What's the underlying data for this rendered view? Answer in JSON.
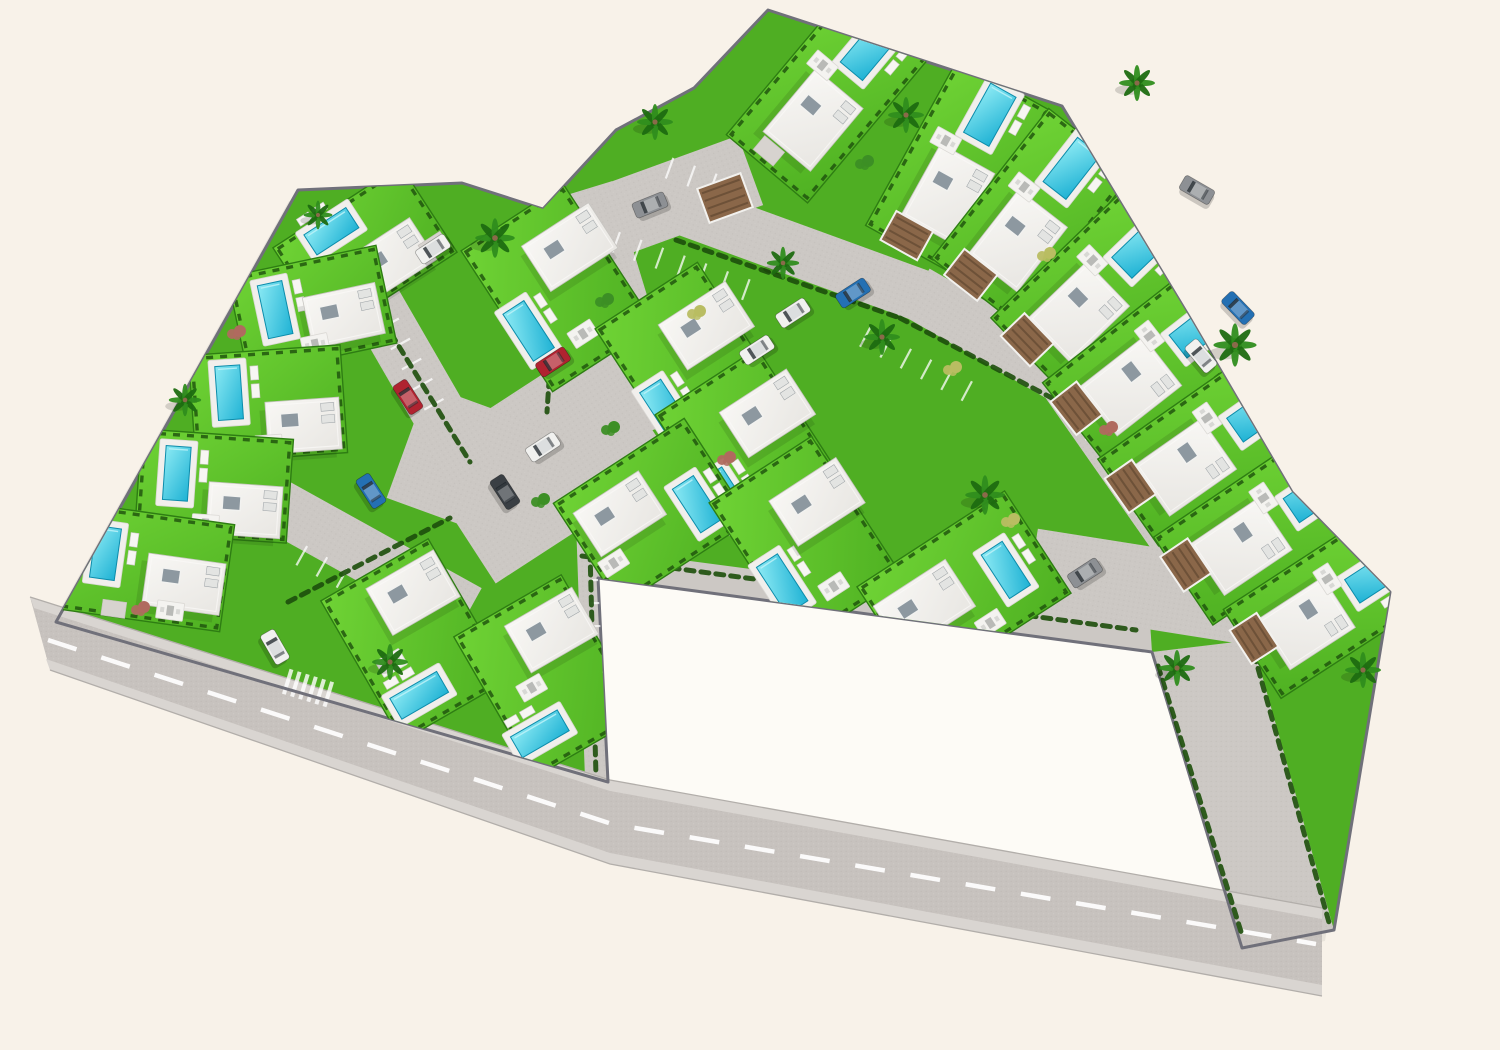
{
  "meta": {
    "canvas": {
      "w": 1500,
      "h": 1050
    }
  },
  "palette": {
    "bg": "#f8f2e9",
    "parcel": "#fdfbf6",
    "grassBase": "#4fae23",
    "lawnLight": "#6fd335",
    "lawnDark": "#4fb122",
    "lawnEdge": "#2e7d13",
    "hedge": "#1d4f0c",
    "road": "#c7c2be",
    "paved": "#ccc8c4",
    "sidewalk": "#d9d5d1",
    "roadEdge": "#b2aeaa",
    "wall": "#70707a",
    "dash": "#ffffff",
    "deck": "#f1efec",
    "waterLight": "#8ceaf4",
    "waterDark": "#1fb2d4",
    "waterEdge": "#0c8cab",
    "roofLight": "#f8f7f4",
    "roofDark": "#e8e6e2",
    "roofStroke": "#c7c5c1",
    "skylight": "#8d98a0",
    "pergola": "#8a6749",
    "pergolaSlat": "#6d5138",
    "drive": "#d7d3cf",
    "carColors": {
      "red": "#b02330",
      "blue": "#2470b3",
      "white": "#f1f1ef",
      "gray": "#8d9094",
      "dark": "#3a3f44"
    }
  },
  "site": {
    "outline": [
      [
        56,
        622
      ],
      [
        298,
        190
      ],
      [
        462,
        183
      ],
      [
        543,
        209
      ],
      [
        616,
        130
      ],
      [
        694,
        88
      ],
      [
        768,
        10
      ],
      [
        1062,
        106
      ],
      [
        1190,
        318
      ],
      [
        1292,
        492
      ],
      [
        1390,
        592
      ],
      [
        1334,
        930
      ],
      [
        1242,
        948
      ],
      [
        1152,
        652
      ],
      [
        598,
        578
      ],
      [
        608,
        782
      ]
    ],
    "parcel": [
      [
        598,
        578
      ],
      [
        1152,
        652
      ],
      [
        1238,
        940
      ],
      [
        608,
        782
      ]
    ]
  },
  "roads": {
    "bottom": [
      [
        30,
        597
      ],
      [
        610,
        780
      ],
      [
        1322,
        908
      ],
      [
        1322,
        996
      ],
      [
        610,
        864
      ],
      [
        50,
        670
      ]
    ],
    "sidewalkTop": [
      [
        30,
        597
      ],
      [
        610,
        780
      ],
      [
        1322,
        908
      ],
      [
        1322,
        919
      ],
      [
        610,
        791
      ],
      [
        34,
        608
      ]
    ],
    "sidewalkBottom": [
      [
        1322,
        985
      ],
      [
        610,
        853
      ],
      [
        46,
        659
      ],
      [
        50,
        670
      ],
      [
        610,
        864
      ],
      [
        1322,
        996
      ]
    ],
    "edgeTop": [
      [
        30,
        597
      ],
      [
        610,
        780
      ],
      [
        1322,
        908
      ]
    ],
    "edgeBottom": [
      [
        50,
        670
      ],
      [
        610,
        864
      ],
      [
        1322,
        996
      ]
    ],
    "dash": [
      [
        48,
        640
      ],
      [
        612,
        824
      ],
      [
        1316,
        944
      ]
    ],
    "strip": [
      [
        1152,
        652
      ],
      [
        1252,
        640
      ],
      [
        1334,
        930
      ],
      [
        1242,
        948
      ]
    ],
    "walk": [
      [
        592,
        548
      ],
      [
        1150,
        622
      ],
      [
        1152,
        652
      ],
      [
        598,
        578
      ]
    ],
    "pavedRects": [
      {
        "x": 618,
        "y": 310,
        "r": -17,
        "w": 64,
        "h": 250
      },
      {
        "x": 680,
        "y": 196,
        "r": -20,
        "w": 150,
        "h": 74
      },
      {
        "x": 790,
        "y": 248,
        "r": 20,
        "w": 300,
        "h": 52
      },
      {
        "x": 1020,
        "y": 352,
        "r": 30,
        "w": 240,
        "h": 54
      },
      {
        "x": 1130,
        "y": 468,
        "r": 55,
        "w": 220,
        "h": 58
      },
      {
        "x": 545,
        "y": 462,
        "r": -33,
        "w": 215,
        "h": 150
      },
      {
        "x": 480,
        "y": 468,
        "r": 20,
        "w": 155,
        "h": 120
      },
      {
        "x": 415,
        "y": 372,
        "r": 60,
        "w": 235,
        "h": 54
      },
      {
        "x": 368,
        "y": 556,
        "r": 29,
        "w": 230,
        "h": 54
      },
      {
        "x": 612,
        "y": 664,
        "r": 88,
        "w": 255,
        "h": 62
      },
      {
        "x": 1150,
        "y": 588,
        "r": 9,
        "w": 240,
        "h": 82
      }
    ],
    "parkingRows": [
      {
        "x": 681,
        "y": 266,
        "r": 20,
        "n": 6
      },
      {
        "x": 916,
        "y": 364,
        "r": 28,
        "n": 5
      },
      {
        "x": 406,
        "y": 354,
        "r": 61,
        "n": 5
      },
      {
        "x": 342,
        "y": 578,
        "r": 29,
        "n": 4
      },
      {
        "x": 602,
        "y": 626,
        "r": 89,
        "n": 4
      },
      {
        "x": 1120,
        "y": 472,
        "r": 56,
        "n": 4
      },
      {
        "x": 702,
        "y": 180,
        "r": 20,
        "n": 3
      }
    ],
    "zebra": {
      "x": 308,
      "y": 688,
      "r": 17,
      "n": 6
    }
  },
  "hedgeLines": [
    [
      676,
      240,
      900,
      318
    ],
    [
      900,
      318,
      1086,
      416
    ],
    [
      582,
      556,
      1136,
      630
    ],
    [
      1158,
      666,
      1243,
      938
    ],
    [
      1254,
      654,
      1330,
      926
    ],
    [
      352,
      270,
      470,
      462
    ],
    [
      288,
      602,
      450,
      518
    ],
    [
      590,
      552,
      596,
      776
    ],
    [
      650,
      552,
      654,
      700
    ],
    [
      560,
      214,
      547,
      412
    ]
  ],
  "villas": [
    {
      "x": 365,
      "y": 250,
      "r": -33,
      "lawn": [
        152,
        104
      ],
      "pool": [
        -18,
        -34,
        50,
        24
      ],
      "house": [
        18,
        22,
        74,
        50
      ],
      "terr": [
        -44,
        6
      ],
      "drive": [
        60,
        34,
        26,
        18
      ]
    },
    {
      "x": 312,
      "y": 310,
      "r": -12,
      "lawn": [
        152,
        100
      ],
      "pool": [
        -36,
        -8,
        25,
        54
      ],
      "house": [
        30,
        12,
        74,
        52
      ],
      "terr": [
        -4,
        34
      ]
    },
    {
      "x": 268,
      "y": 404,
      "r": -4,
      "lawn": [
        152,
        108
      ],
      "pool": [
        -38,
        -14,
        25,
        54
      ],
      "house": [
        34,
        24,
        74,
        52
      ],
      "terr": [
        -2,
        40
      ]
    },
    {
      "x": 214,
      "y": 486,
      "r": 4,
      "lawn": [
        152,
        104
      ],
      "pool": [
        -38,
        -10,
        25,
        54
      ],
      "house": [
        32,
        22,
        74,
        52
      ],
      "terr": [
        -6,
        38
      ]
    },
    {
      "x": 140,
      "y": 566,
      "r": 8,
      "lawn": [
        176,
        108
      ],
      "pool": [
        -36,
        -8,
        25,
        52
      ],
      "house": [
        46,
        12,
        78,
        52
      ],
      "terr": [
        36,
        40
      ],
      "drive": [
        -20,
        46,
        24,
        16
      ]
    },
    {
      "x": 415,
      "y": 640,
      "r": -30,
      "lawn": [
        124,
        162
      ],
      "pool": [
        -24,
        50,
        54,
        24
      ],
      "house": [
        22,
        -42,
        78,
        54
      ],
      "terr": [
        -32,
        8
      ]
    },
    {
      "x": 548,
      "y": 676,
      "r": -30,
      "lawn": [
        124,
        162
      ],
      "pool": [
        -36,
        46,
        54,
        24
      ],
      "house": [
        26,
        -38,
        78,
        54
      ],
      "terr": [
        -20,
        2
      ]
    },
    {
      "x": 558,
      "y": 288,
      "r": -33,
      "lawn": [
        122,
        168
      ],
      "house": [
        32,
        -28,
        80,
        54
      ],
      "pool": [
        -48,
        20,
        25,
        56
      ],
      "terr": [
        -4,
        52
      ]
    },
    {
      "x": 692,
      "y": 366,
      "r": -33,
      "lawn": [
        122,
        168
      ],
      "house": [
        34,
        -26,
        80,
        54
      ],
      "pool": [
        -46,
        22,
        25,
        56
      ],
      "terr": [
        -4,
        54
      ]
    },
    {
      "x": 752,
      "y": 452,
      "r": -33,
      "lawn": [
        122,
        168
      ],
      "house": [
        34,
        -24,
        80,
        54
      ],
      "pool": [
        -46,
        24,
        25,
        56
      ],
      "terr": [
        -2,
        56
      ]
    },
    {
      "x": 652,
      "y": 512,
      "r": -33,
      "lawn": [
        156,
        122
      ],
      "house": [
        -28,
        -16,
        78,
        52
      ],
      "pool": [
        42,
        18,
        25,
        52
      ],
      "terr": [
        -60,
        22
      ]
    },
    {
      "x": 806,
      "y": 540,
      "r": -33,
      "lawn": [
        122,
        168
      ],
      "house": [
        30,
        -26,
        80,
        54
      ],
      "pool": [
        -44,
        24,
        25,
        56
      ],
      "terr": [
        -2,
        54
      ]
    },
    {
      "x": 964,
      "y": 590,
      "r": -33,
      "lawn": [
        176,
        122
      ],
      "house": [
        -42,
        -8,
        86,
        56
      ],
      "pool": [
        46,
        6,
        25,
        52
      ],
      "terr": [
        4,
        42
      ]
    },
    {
      "x": 828,
      "y": 96,
      "r": 40,
      "lawn": [
        106,
        190
      ],
      "pool": [
        2,
        -62,
        29,
        56
      ],
      "house": [
        4,
        28,
        62,
        82
      ],
      "terr": [
        -24,
        -20
      ],
      "drive": [
        -10,
        80,
        26,
        18
      ]
    },
    {
      "x": 958,
      "y": 168,
      "r": 29,
      "lawn": [
        106,
        190
      ],
      "pool": [
        2,
        -62,
        29,
        56
      ],
      "house": [
        4,
        28,
        62,
        82
      ],
      "terr": [
        -24,
        -18
      ],
      "perg": [
        -12,
        84,
        42,
        33
      ]
    },
    {
      "x": 1032,
      "y": 216,
      "r": 38,
      "lawn": [
        106,
        190
      ],
      "pool": [
        2,
        -62,
        29,
        56
      ],
      "house": [
        4,
        28,
        62,
        82
      ],
      "terr": [
        -24,
        -18
      ],
      "perg": [
        -12,
        84,
        42,
        33
      ]
    },
    {
      "x": 1096,
      "y": 290,
      "r": 46,
      "lawn": [
        106,
        190
      ],
      "pool": [
        2,
        -62,
        29,
        56
      ],
      "house": [
        4,
        28,
        62,
        82
      ],
      "terr": [
        -24,
        -18
      ],
      "perg": [
        -12,
        84,
        42,
        33
      ]
    },
    {
      "x": 1150,
      "y": 366,
      "r": 52,
      "lawn": [
        106,
        190
      ],
      "pool": [
        2,
        -62,
        29,
        56
      ],
      "house": [
        4,
        28,
        62,
        82
      ],
      "terr": [
        -24,
        -18
      ],
      "perg": [
        -12,
        84,
        42,
        33
      ]
    },
    {
      "x": 1206,
      "y": 448,
      "r": 55,
      "lawn": [
        106,
        190
      ],
      "pool": [
        2,
        -62,
        29,
        56
      ],
      "house": [
        4,
        28,
        62,
        82
      ],
      "terr": [
        -24,
        -18
      ],
      "perg": [
        -12,
        84,
        42,
        33
      ]
    },
    {
      "x": 1262,
      "y": 528,
      "r": 56,
      "lawn": [
        106,
        190
      ],
      "pool": [
        2,
        -62,
        29,
        56
      ],
      "house": [
        4,
        28,
        62,
        82
      ],
      "terr": [
        -24,
        -18
      ],
      "perg": [
        -12,
        84,
        42,
        33
      ]
    },
    {
      "x": 1326,
      "y": 606,
      "r": 57,
      "lawn": [
        106,
        176
      ],
      "pool": [
        2,
        -56,
        28,
        52
      ],
      "house": [
        4,
        26,
        60,
        78
      ],
      "terr": [
        -22,
        -16
      ],
      "perg": [
        -12,
        78,
        40,
        32
      ]
    }
  ],
  "pergolasExtra": [
    {
      "x": 725,
      "y": 198,
      "r": -20,
      "w": 46,
      "h": 36
    }
  ],
  "palms": [
    [
      495,
      238,
      1.1
    ],
    [
      655,
      122,
      1
    ],
    [
      906,
      115,
      1
    ],
    [
      1137,
      83,
      1
    ],
    [
      783,
      263,
      0.9
    ],
    [
      882,
      337,
      1
    ],
    [
      985,
      495,
      1.1
    ],
    [
      1235,
      345,
      1.2
    ],
    [
      1177,
      668,
      1
    ],
    [
      1363,
      670,
      1
    ],
    [
      390,
      662,
      1
    ],
    [
      185,
      400,
      0.9
    ],
    [
      318,
      215,
      0.8
    ]
  ],
  "bushes": [
    [
      140,
      608,
      "r"
    ],
    [
      236,
      332,
      "r"
    ],
    [
      604,
      300,
      "g"
    ],
    [
      696,
      312,
      "y"
    ],
    [
      726,
      458,
      "r"
    ],
    [
      952,
      368,
      "y"
    ],
    [
      1046,
      254,
      "y"
    ],
    [
      864,
      162,
      "g"
    ],
    [
      610,
      428,
      "g"
    ],
    [
      1108,
      428,
      "r"
    ],
    [
      540,
      500,
      "g"
    ],
    [
      1010,
      520,
      "y"
    ]
  ],
  "cars": [
    [
      553,
      362,
      -33,
      "red"
    ],
    [
      408,
      397,
      57,
      "red"
    ],
    [
      371,
      491,
      57,
      "blue"
    ],
    [
      505,
      492,
      57,
      "dark"
    ],
    [
      543,
      447,
      -33,
      "white"
    ],
    [
      757,
      350,
      -33,
      "white"
    ],
    [
      793,
      313,
      -33,
      "white"
    ],
    [
      853,
      293,
      -33,
      "blue"
    ],
    [
      650,
      205,
      -22,
      "gray"
    ],
    [
      1085,
      573,
      -33,
      "gray"
    ],
    [
      1197,
      190,
      30,
      "gray"
    ],
    [
      1238,
      308,
      46,
      "blue"
    ],
    [
      1201,
      356,
      50,
      "white"
    ],
    [
      275,
      647,
      60,
      "white"
    ],
    [
      433,
      249,
      -33,
      "white"
    ]
  ]
}
